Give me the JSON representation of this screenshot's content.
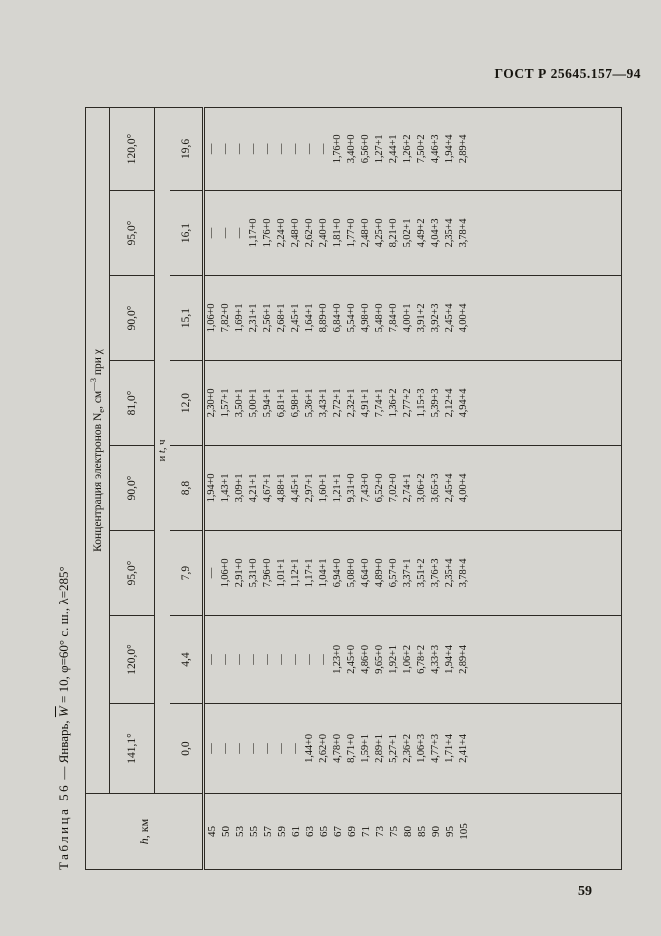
{
  "page": {
    "standard_ref": "ГОСТ Р 25645.157—94",
    "page_number": "59"
  },
  "table": {
    "title": {
      "label": "Таблица 56",
      "pre_w": " — Январь, ",
      "w": "W",
      "post_w": " = 10, φ=60° с. ш., λ=285°"
    },
    "header": {
      "h_col_italic": "h",
      "h_col_rest": ", км",
      "ne_prefix": "Концентрация электронов N",
      "ne_sub": "e",
      "ne_mid": ", см",
      "ne_sup": "—3",
      "ne_suffix": " при χ",
      "and_t_pre": "и ",
      "and_t_it": "t",
      "and_t_post": ", ч",
      "chi_values": [
        "141,1°",
        "120,0°",
        "95,0°",
        "90,0°",
        "81,0°",
        "90,0°",
        "95,0°",
        "120,0°"
      ],
      "t_values": [
        "0,0",
        "4,4",
        "7,9",
        "8,8",
        "12,0",
        "15,1",
        "16,1",
        "19,6"
      ]
    },
    "rows": [
      {
        "h": "45",
        "values": [
          "—",
          "—",
          "—",
          "1,94+0",
          "2,30+0",
          "1,06+0",
          "—",
          "—"
        ]
      },
      {
        "h": "50",
        "values": [
          "—",
          "—",
          "1,06+0",
          "1,43+1",
          "1,57+1",
          "7,82+0",
          "—",
          "—"
        ]
      },
      {
        "h": "53",
        "values": [
          "—",
          "—",
          "2,91+0",
          "3,09+1",
          "3,50+1",
          "1,69+1",
          "—",
          "—"
        ]
      },
      {
        "h": "55",
        "values": [
          "—",
          "—",
          "5,31+0",
          "4,21+1",
          "5,00+1",
          "2,31+1",
          "1,17+0",
          "—"
        ]
      },
      {
        "h": "57",
        "values": [
          "—",
          "—",
          "7,96+0",
          "4,67+1",
          "5,94+1",
          "2,56+1",
          "1,76+0",
          "—"
        ]
      },
      {
        "h": "59",
        "values": [
          "—",
          "—",
          "1,01+1",
          "4,88+1",
          "6,81+1",
          "2,68+1",
          "2,24+0",
          "—"
        ]
      },
      {
        "h": "61",
        "values": [
          "—",
          "—",
          "1,12+1",
          "4,45+1",
          "6,98+1",
          "2,45+1",
          "2,48+0",
          "—"
        ]
      },
      {
        "h": "63",
        "values": [
          "1,44+0",
          "—",
          "1,17+1",
          "2,97+1",
          "5,36+1",
          "1,64+1",
          "2,62+0",
          "—"
        ]
      },
      {
        "h": "65",
        "values": [
          "2,62+0",
          "—",
          "1,04+1",
          "1,60+1",
          "3,43+1",
          "8,89+0",
          "2,40+0",
          "—"
        ]
      },
      {
        "h": "67",
        "values": [
          "4,78+0",
          "1,23+0",
          "6,94+0",
          "1,21+1",
          "2,72+1",
          "6,84+0",
          "1,81+0",
          "1,76+0"
        ]
      },
      {
        "h": "69",
        "values": [
          "8,71+0",
          "2,45+0",
          "5,08+0",
          "9,31+0",
          "2,32+1",
          "5,54+0",
          "1,77+0",
          "3,40+0"
        ]
      },
      {
        "h": "71",
        "values": [
          "1,59+1",
          "4,86+0",
          "4,64+0",
          "7,43+0",
          "4,91+1",
          "4,98+0",
          "2,48+0",
          "6,56+0"
        ]
      },
      {
        "h": "73",
        "values": [
          "2,89+1",
          "9,65+0",
          "4,89+0",
          "6,52+0",
          "7,74+1",
          "5,48+0",
          "4,25+0",
          "1,27+1"
        ]
      },
      {
        "h": "75",
        "values": [
          "5,27+1",
          "1,92+1",
          "6,57+0",
          "7,02+0",
          "1,36+2",
          "7,84+0",
          "8,21+0",
          "2,44+1"
        ]
      },
      {
        "h": "80",
        "values": [
          "2,36+2",
          "1,06+2",
          "3,37+1",
          "2,74+1",
          "2,77+2",
          "4,00+1",
          "5,02+1",
          "1,26+2"
        ]
      },
      {
        "h": "85",
        "values": [
          "1,06+3",
          "6,78+2",
          "3,51+2",
          "3,06+2",
          "1,15+3",
          "3,91+2",
          "4,49+2",
          "7,50+2"
        ]
      },
      {
        "h": "90",
        "values": [
          "4,77+3",
          "4,33+3",
          "3,76+3",
          "3,65+3",
          "5,39+3",
          "3,92+3",
          "4,04+3",
          "4,46+3"
        ]
      },
      {
        "h": "95",
        "values": [
          "1,71+4",
          "1,94+4",
          "2,35+4",
          "2,45+4",
          "2,12+4",
          "2,45+4",
          "2,35+4",
          "1,94+4"
        ]
      },
      {
        "h": "105",
        "values": [
          "2,41+4",
          "2,89+4",
          "3,78+4",
          "4,00+4",
          "4,94+4",
          "4,00+4",
          "3,78+4",
          "2,89+4"
        ]
      }
    ]
  }
}
